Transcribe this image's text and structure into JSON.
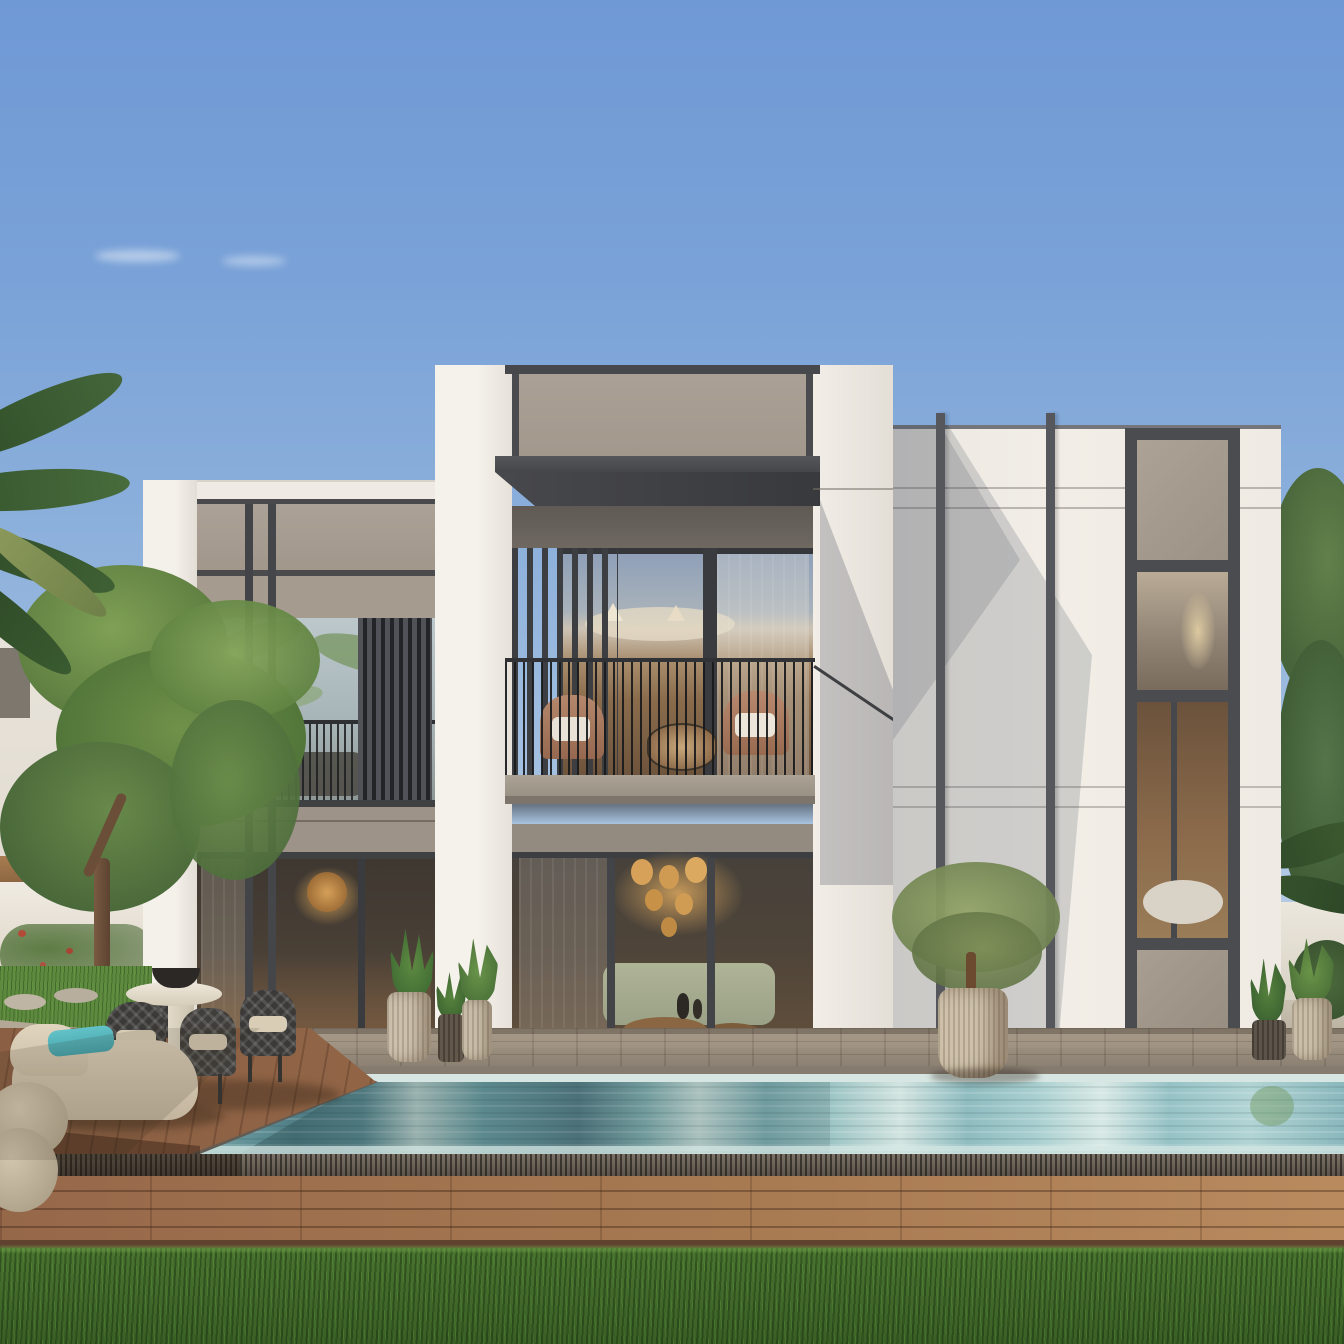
{
  "scene": {
    "title": "Modern two-storey white villa exterior with swimming pool, wooden deck and garden, daytime render",
    "sky": "clear blue sky, light haze near rooflines, two faint wisps of cloud",
    "sections": {
      "left_wing": "two-storey wing clad in grey concrete panels, dark mullions, upper windows with palm reflections, fine-bar balcony rail, vertical louver screen, ground-floor glazing with warm interior",
      "central_tower": "tall white tower, grey attic panel, dark projecting canopy, recessed balcony with slat screen, rail, two wicker chairs and round table, ground-floor glazing with chandelier and sofa",
      "right_wing": "white volume with two vertical dark fins, thin reveal lines, full-height dark-framed window column alternating stone panels and glass, diagonal cast shadows"
    },
    "foreground": "stone paver terrace, rectangular pool with dark coping and drain grate, hardwood deck, fresh lawn strip",
    "landscape": "palm fronds top-left, leafy tree on left with villas and white garden wall behind, dense trees and palm on the right edge"
  },
  "palette": {
    "sky_top": "#6f99d5",
    "sky_low": "#c9d9ea",
    "wall_white": "#f1ede6",
    "wall_shadow": "#c9c9cd",
    "concrete_panel": "#a79d92",
    "concrete_dark": "#8e857a",
    "frame_dark": "#44454a",
    "canopy": "#3c3d41",
    "glass_cool": "#b5c3c7",
    "glass_warm": "#7c5f44",
    "chandelier_gold": "#d7a159",
    "water_light": "#cfe2de",
    "water_mid": "#76a6aa",
    "water_deep": "#4f7a84",
    "coping": "#655e55",
    "paver": "#9e9181",
    "deck_wood": "#a06f4e",
    "deck_dark": "#6b4531",
    "grass_front": "#41682a",
    "lawn": "#5d8a3f",
    "foliage": "#5e7e44",
    "foliage_dark": "#3c5a2e",
    "cushion_beige": "#d8cbb5",
    "pillow_teal": "#57b5bd",
    "chair_charcoal": "#3b3a38",
    "pot_beige": "#c9bca6",
    "pot_dark": "#55493c",
    "wicker_chair": "#b5876c"
  },
  "objects": {
    "balcony_chairs": 2,
    "balcony_table": 1,
    "dining_chairs": 4,
    "dining_table": 1,
    "table_bowl": 1,
    "chaise_lounges": 1,
    "poufs": 2,
    "teal_pillows": 1,
    "planter_pots": 7,
    "olive_tree": 1,
    "pool": 1,
    "drain_grates": 1,
    "path_stones": 2
  }
}
